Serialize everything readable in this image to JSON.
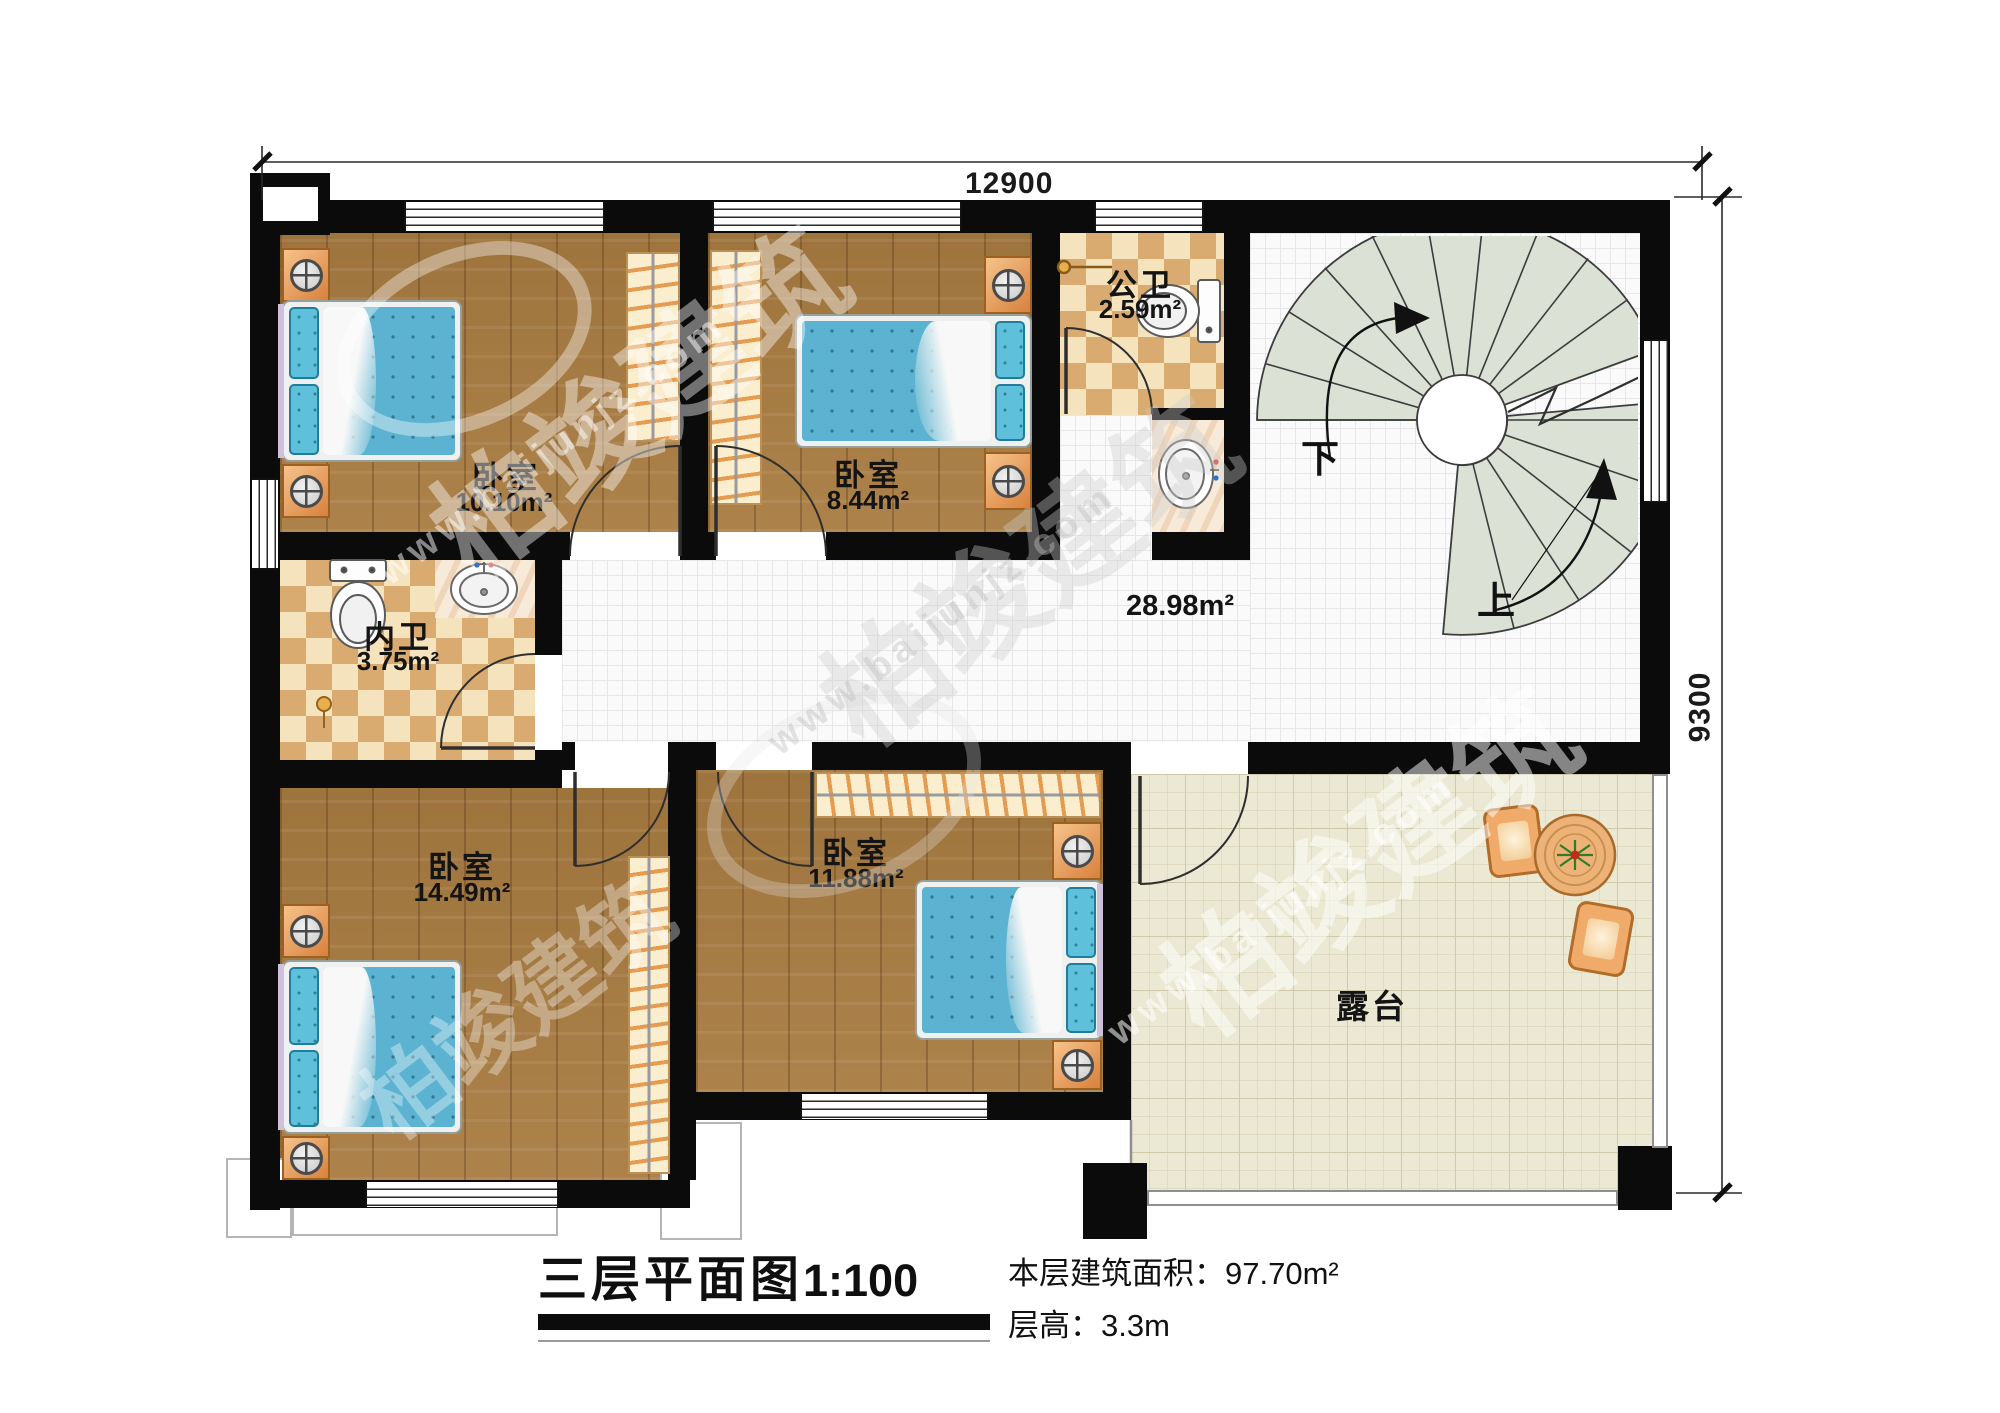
{
  "title": {
    "main": "三层平面图",
    "scale": "1:100"
  },
  "info": {
    "area_label": "本层建筑面积：",
    "area_value": "97.70m²",
    "height_label": "层高：",
    "height_value": "3.3m"
  },
  "dimensions": {
    "top": "12900",
    "right": "9300"
  },
  "rooms": {
    "bedroom1": {
      "name": "卧室",
      "area": "10.10m²"
    },
    "bedroom2": {
      "name": "卧室",
      "area": "8.44m²"
    },
    "public_bath": {
      "name": "公卫",
      "area": "2.59m²"
    },
    "inner_bath": {
      "name": "内卫",
      "area": "3.75m²"
    },
    "bedroom3": {
      "name": "卧室",
      "area": "14.49m²"
    },
    "bedroom4": {
      "name": "卧室",
      "area": "11.88m²"
    },
    "hallway": {
      "area": "28.98m²"
    },
    "terrace": {
      "name": "露台"
    }
  },
  "stairs": {
    "down": "下",
    "up": "上"
  },
  "watermark": {
    "brand": "柏竣建筑",
    "url": "www.baijunjz.com"
  },
  "colors": {
    "wall": "#0b0b0b",
    "wood_floor": "#a87b41",
    "bath_tile_dark": "#d9ab71",
    "bath_tile_light": "#f4e3bc",
    "hall_tile": "#fafafa",
    "terrace_floor": "#ebe8d3",
    "stair_tread": "#dce1d6",
    "bed_blanket": "#5cb3d1",
    "furniture_orange": "#e8984f"
  }
}
